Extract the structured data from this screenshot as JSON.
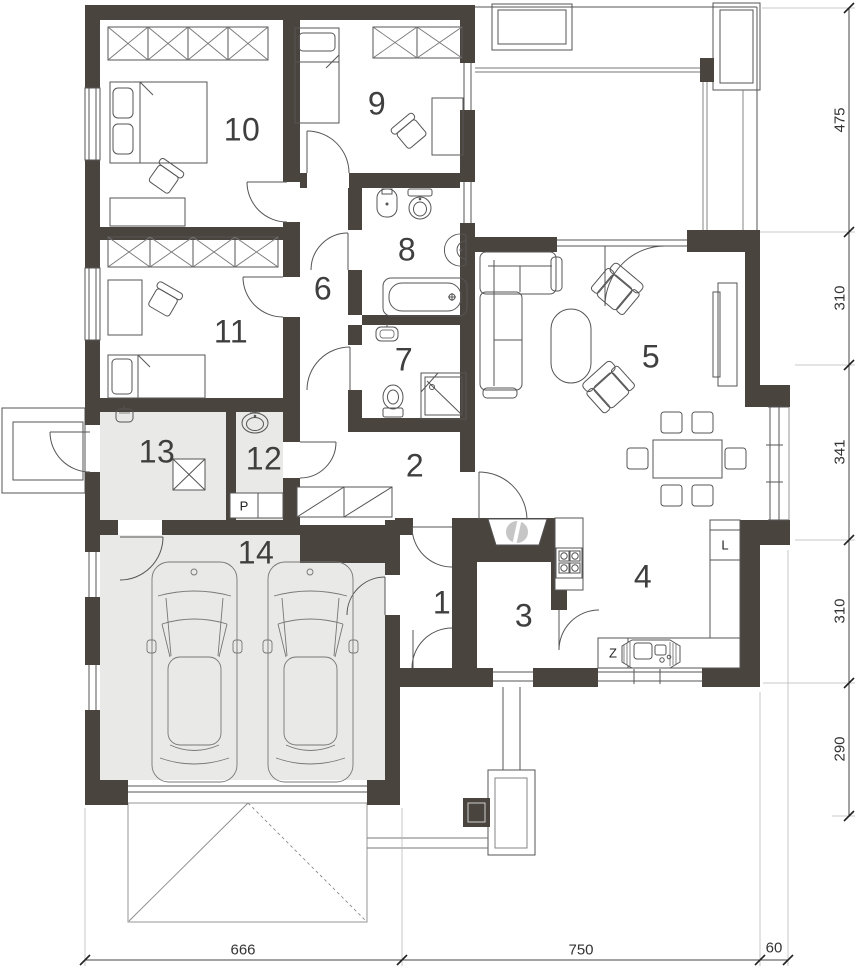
{
  "plan": {
    "room_numbers": [
      "1",
      "2",
      "3",
      "4",
      "5",
      "6",
      "7",
      "8",
      "9",
      "10",
      "11",
      "12",
      "13",
      "14"
    ],
    "fixture_labels": {
      "pantry_p": "P",
      "fridge_l": "L",
      "sink_z": "Z"
    },
    "dimensions": {
      "right": [
        "475",
        "310",
        "341",
        "310",
        "290"
      ],
      "bottom": [
        "666",
        "750",
        "60"
      ]
    },
    "colors": {
      "wall": "#4a443f",
      "shaded_floor": "#e9e9e7",
      "line": "#555555",
      "text": "#3f3f3f"
    }
  }
}
